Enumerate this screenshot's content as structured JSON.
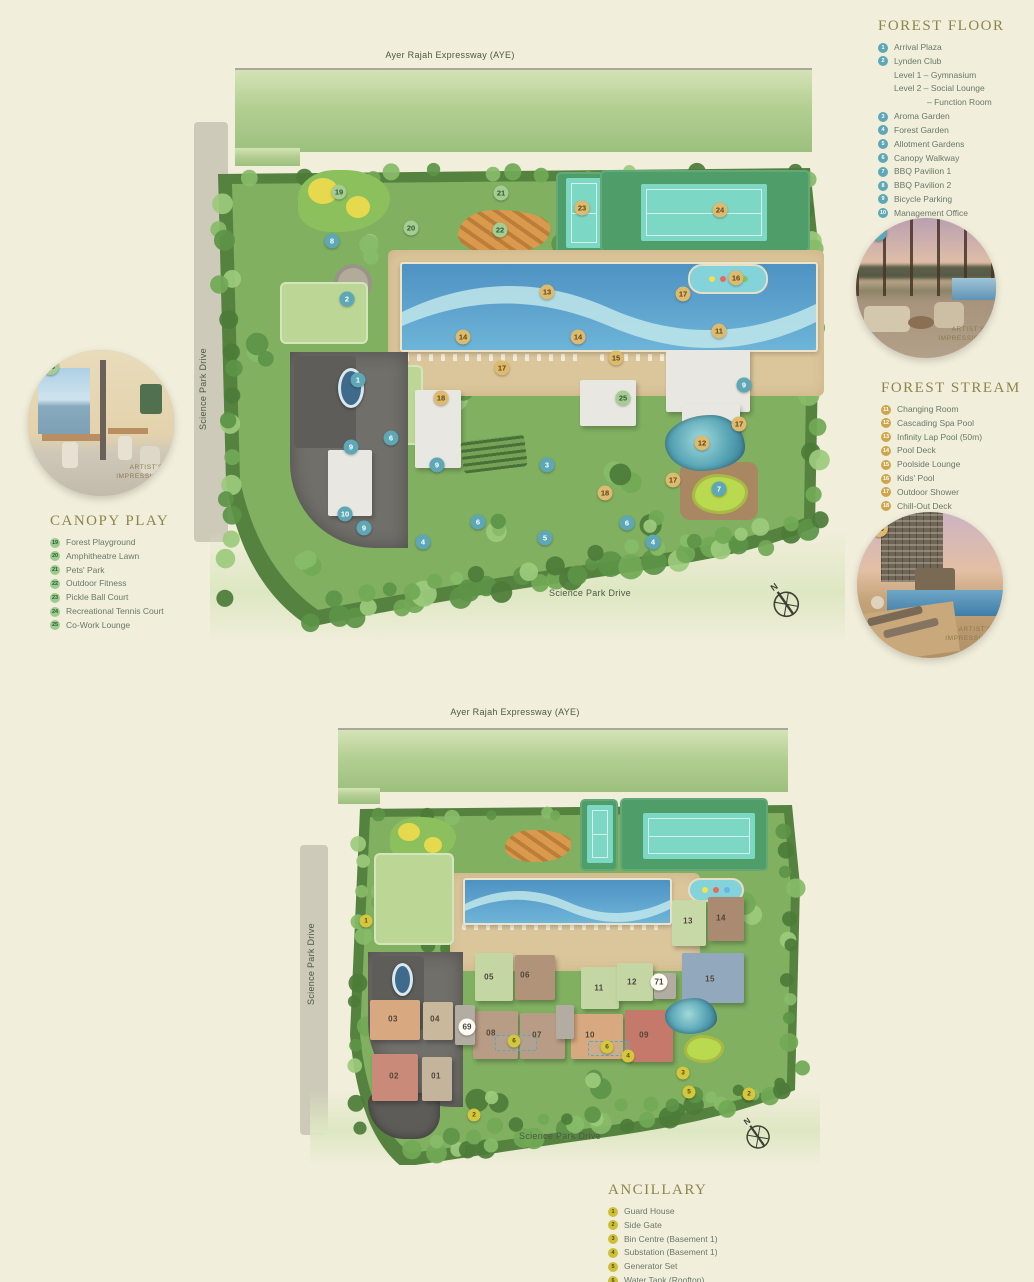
{
  "page": {
    "background": "#f1eedb",
    "accent_olive": "#8b874c",
    "marker_teal": "#5ea7b6",
    "marker_gold": "#ddba6e",
    "marker_green": "#a5cd92",
    "marker_yellow": "#d5c63e"
  },
  "legends": {
    "forest_floor": {
      "title": "FOREST FLOOR",
      "badge": "teal",
      "items": [
        {
          "n": "1",
          "label": "Arrival Plaza"
        },
        {
          "n": "2",
          "label": "Lynden Club",
          "sublines": [
            {
              "text": "Level 1 – Gymnasium",
              "indent": 1
            },
            {
              "text": "Level 2 – Social Lounge",
              "indent": 1
            },
            {
              "text": "– Function Room",
              "indent": 2
            }
          ]
        },
        {
          "n": "3",
          "label": "Aroma Garden"
        },
        {
          "n": "4",
          "label": "Forest Garden"
        },
        {
          "n": "5",
          "label": "Allotment Gardens"
        },
        {
          "n": "6",
          "label": "Canopy Walkway"
        },
        {
          "n": "7",
          "label": "BBQ Pavilion 1"
        },
        {
          "n": "8",
          "label": "BBQ Pavilion 2"
        },
        {
          "n": "9",
          "label": "Bicycle Parking"
        },
        {
          "n": "10",
          "label": "Management Office"
        }
      ]
    },
    "forest_stream": {
      "title": "FOREST STREAM",
      "badge": "gold",
      "items": [
        {
          "n": "11",
          "label": "Changing Room"
        },
        {
          "n": "12",
          "label": "Cascading Spa Pool"
        },
        {
          "n": "13",
          "label": "Infinity Lap Pool (50m)"
        },
        {
          "n": "14",
          "label": "Pool Deck"
        },
        {
          "n": "15",
          "label": "Poolside Lounge"
        },
        {
          "n": "16",
          "label": "Kids' Pool"
        },
        {
          "n": "17",
          "label": "Outdoor Shower"
        },
        {
          "n": "18",
          "label": "Chill-Out Deck"
        }
      ]
    },
    "canopy_play": {
      "title": "CANOPY PLAY",
      "badge": "green",
      "items": [
        {
          "n": "19",
          "label": "Forest Playground"
        },
        {
          "n": "20",
          "label": "Amphitheatre Lawn"
        },
        {
          "n": "21",
          "label": "Pets' Park"
        },
        {
          "n": "22",
          "label": "Outdoor Fitness"
        },
        {
          "n": "23",
          "label": "Pickle Ball Court"
        },
        {
          "n": "24",
          "label": "Recreational Tennis Court"
        },
        {
          "n": "25",
          "label": "Co-Work Lounge"
        }
      ]
    },
    "ancillary": {
      "title": "ANCILLARY",
      "badge": "yellow",
      "items": [
        {
          "n": "1",
          "label": "Guard House"
        },
        {
          "n": "2",
          "label": "Side Gate"
        },
        {
          "n": "3",
          "label": "Bin Centre (Basement 1)"
        },
        {
          "n": "4",
          "label": "Substation (Basement 1)"
        },
        {
          "n": "5",
          "label": "Generator Set"
        },
        {
          "n": "6",
          "label": "Water Tank (Rooftop)"
        }
      ]
    }
  },
  "maps": {
    "top": {
      "labels": {
        "expressway": "Ayer Rajah Expressway (AYE)",
        "road_left": "Science Park Drive",
        "road_bottom": "Science Park Drive"
      },
      "compass_n": "N",
      "markers": [
        {
          "n": "1",
          "c": "teal",
          "x": 148,
          "y": 328
        },
        {
          "n": "2",
          "c": "teal",
          "x": 137,
          "y": 247
        },
        {
          "n": "3",
          "c": "teal",
          "x": 337,
          "y": 413
        },
        {
          "n": "4",
          "c": "teal",
          "x": 213,
          "y": 490
        },
        {
          "n": "4",
          "c": "teal",
          "x": 443,
          "y": 490
        },
        {
          "n": "5",
          "c": "teal",
          "x": 335,
          "y": 486
        },
        {
          "n": "6",
          "c": "teal",
          "x": 181,
          "y": 386
        },
        {
          "n": "6",
          "c": "teal",
          "x": 268,
          "y": 470
        },
        {
          "n": "6",
          "c": "teal",
          "x": 417,
          "y": 471
        },
        {
          "n": "7",
          "c": "teal",
          "x": 509,
          "y": 437
        },
        {
          "n": "8",
          "c": "teal",
          "x": 122,
          "y": 189
        },
        {
          "n": "9",
          "c": "teal",
          "x": 141,
          "y": 395
        },
        {
          "n": "9",
          "c": "teal",
          "x": 227,
          "y": 413
        },
        {
          "n": "9",
          "c": "teal",
          "x": 154,
          "y": 476
        },
        {
          "n": "9",
          "c": "teal",
          "x": 534,
          "y": 333
        },
        {
          "n": "10",
          "c": "teal",
          "x": 135,
          "y": 462
        },
        {
          "n": "11",
          "c": "gold",
          "x": 509,
          "y": 279
        },
        {
          "n": "12",
          "c": "gold",
          "x": 492,
          "y": 391
        },
        {
          "n": "13",
          "c": "gold",
          "x": 337,
          "y": 240
        },
        {
          "n": "14",
          "c": "gold",
          "x": 253,
          "y": 285
        },
        {
          "n": "14",
          "c": "gold",
          "x": 368,
          "y": 285
        },
        {
          "n": "15",
          "c": "gold",
          "x": 406,
          "y": 306
        },
        {
          "n": "16",
          "c": "gold",
          "x": 526,
          "y": 226
        },
        {
          "n": "17",
          "c": "gold",
          "x": 473,
          "y": 242
        },
        {
          "n": "17",
          "c": "gold",
          "x": 292,
          "y": 316
        },
        {
          "n": "17",
          "c": "gold",
          "x": 529,
          "y": 372
        },
        {
          "n": "17",
          "c": "gold",
          "x": 463,
          "y": 428
        },
        {
          "n": "18",
          "c": "gold",
          "x": 231,
          "y": 346
        },
        {
          "n": "18",
          "c": "gold",
          "x": 395,
          "y": 441
        },
        {
          "n": "23",
          "c": "gold",
          "x": 372,
          "y": 156
        },
        {
          "n": "24",
          "c": "gold",
          "x": 510,
          "y": 158
        },
        {
          "n": "19",
          "c": "green",
          "x": 129,
          "y": 140
        },
        {
          "n": "20",
          "c": "green",
          "x": 201,
          "y": 176
        },
        {
          "n": "21",
          "c": "green",
          "x": 291,
          "y": 141
        },
        {
          "n": "22",
          "c": "green",
          "x": 290,
          "y": 178
        },
        {
          "n": "25",
          "c": "green",
          "x": 413,
          "y": 346
        }
      ]
    },
    "bottom": {
      "labels": {
        "expressway": "Ayer Rajah Expressway (AYE)",
        "road_left": "Science Park Drive",
        "road_bottom": "Science Park Drive"
      },
      "compass_n": "N",
      "markers": [
        {
          "n": "1",
          "c": "yellow",
          "x": 56,
          "y": 216
        },
        {
          "n": "2",
          "c": "yellow",
          "x": 164,
          "y": 410
        },
        {
          "n": "2",
          "c": "yellow",
          "x": 439,
          "y": 389
        },
        {
          "n": "3",
          "c": "yellow",
          "x": 373,
          "y": 368
        },
        {
          "n": "4",
          "c": "yellow",
          "x": 318,
          "y": 351
        },
        {
          "n": "5",
          "c": "yellow",
          "x": 379,
          "y": 387
        },
        {
          "n": "6",
          "c": "yellow",
          "x": 204,
          "y": 336
        },
        {
          "n": "6",
          "c": "yellow",
          "x": 297,
          "y": 342
        },
        {
          "n": "69",
          "c": "white",
          "x": 157,
          "y": 322
        },
        {
          "n": "71",
          "c": "white",
          "x": 349,
          "y": 277
        },
        {
          "n": "01",
          "c": "block",
          "x": 126,
          "y": 371
        },
        {
          "n": "02",
          "c": "block",
          "x": 84,
          "y": 371
        },
        {
          "n": "03",
          "c": "block",
          "x": 83,
          "y": 314
        },
        {
          "n": "04",
          "c": "block",
          "x": 125,
          "y": 314
        },
        {
          "n": "05",
          "c": "block",
          "x": 179,
          "y": 272
        },
        {
          "n": "06",
          "c": "block",
          "x": 215,
          "y": 270
        },
        {
          "n": "07",
          "c": "block",
          "x": 227,
          "y": 330
        },
        {
          "n": "08",
          "c": "block",
          "x": 181,
          "y": 328
        },
        {
          "n": "09",
          "c": "block",
          "x": 334,
          "y": 330
        },
        {
          "n": "10",
          "c": "block",
          "x": 280,
          "y": 330
        },
        {
          "n": "11",
          "c": "block",
          "x": 289,
          "y": 283
        },
        {
          "n": "12",
          "c": "block",
          "x": 322,
          "y": 277
        },
        {
          "n": "13",
          "c": "block",
          "x": 378,
          "y": 216
        },
        {
          "n": "14",
          "c": "block",
          "x": 411,
          "y": 213
        },
        {
          "n": "15",
          "c": "block",
          "x": 400,
          "y": 274
        }
      ]
    }
  },
  "photos": {
    "p2": {
      "badge": "2",
      "caption": "ARTIST'S IMPRESSION"
    },
    "p13": {
      "badge": "13",
      "caption": "ARTIST'S IMPRESSION"
    },
    "p25": {
      "badge": "25",
      "caption": "ARTIST'S IMPRESSION"
    }
  }
}
